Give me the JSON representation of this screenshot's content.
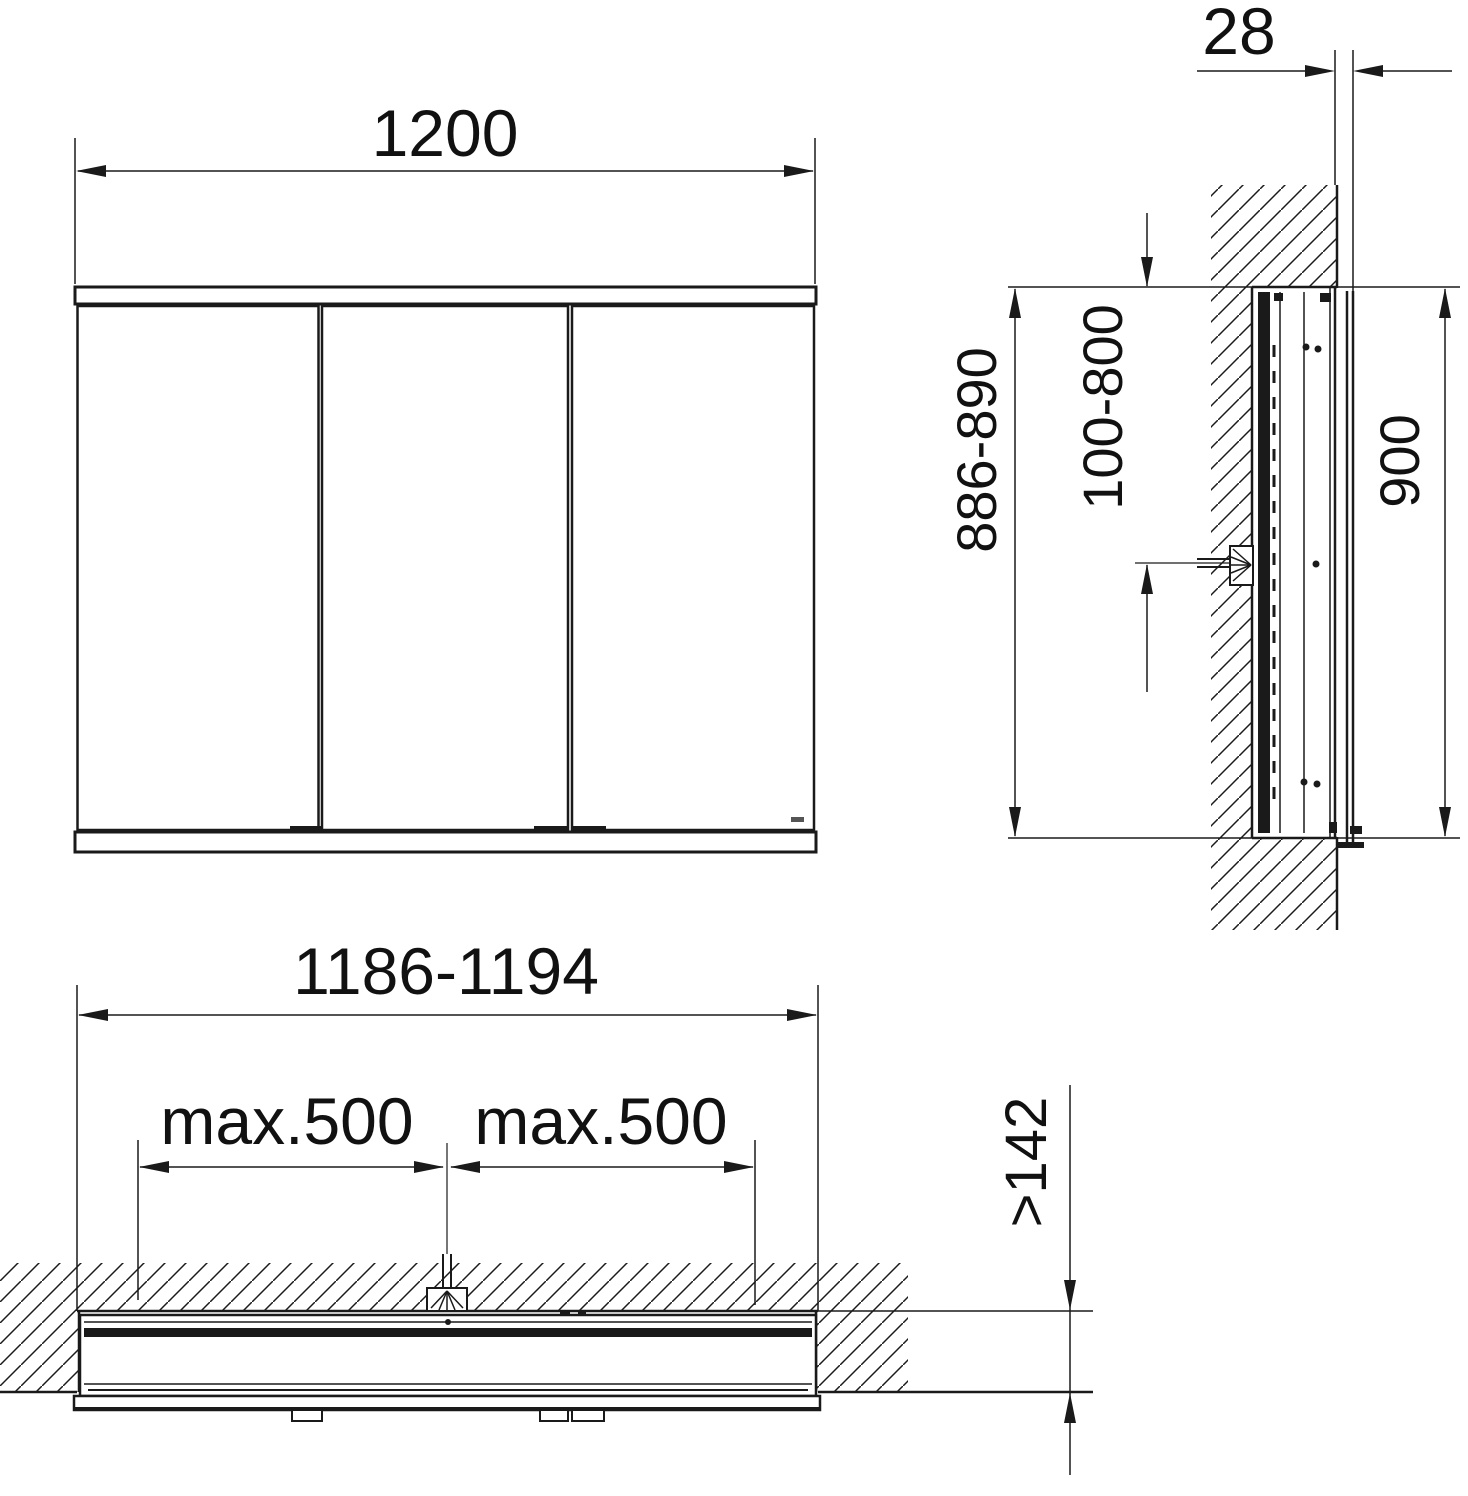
{
  "dimensions": {
    "front_width": "1200",
    "side_depth": "28",
    "side_cutout_height": "886-890",
    "side_connection_height": "100-800",
    "side_height": "900",
    "plan_niche_width": "1186-1194",
    "plan_max_left": "max.500",
    "plan_max_right": "max.500",
    "plan_niche_depth": ">142"
  },
  "symbols": {
    "power_connection": "mains-connection-fan-symbol",
    "wall_section": "diagonal-hatch"
  },
  "colors": {
    "line": "#1a1a1a",
    "background": "#ffffff",
    "logo_mark": "#555555"
  }
}
